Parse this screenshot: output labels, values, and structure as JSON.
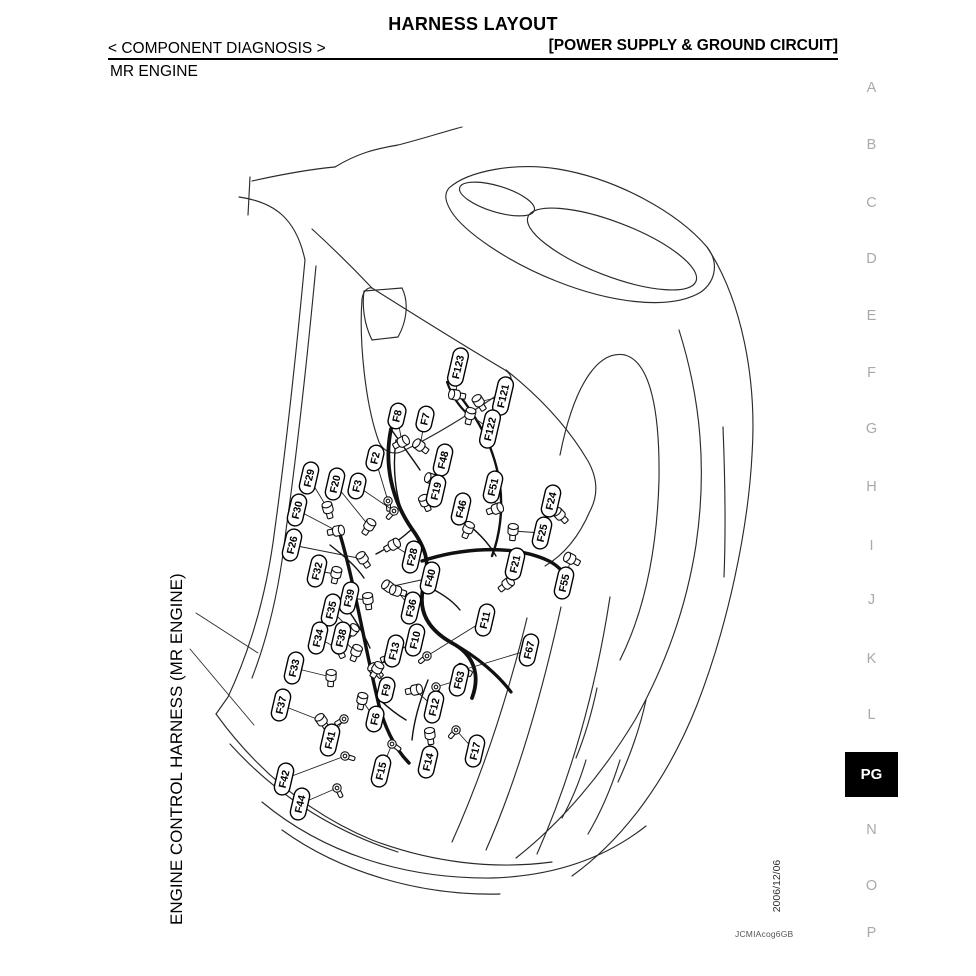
{
  "page": {
    "bg": "#ffffff",
    "ink": "#000000"
  },
  "header": {
    "title": "HARNESS LAYOUT",
    "section": "< COMPONENT DIAGNOSIS >",
    "subsection": "[POWER SUPPLY & GROUND CIRCUIT]",
    "page_heading": "MR ENGINE"
  },
  "diagram": {
    "side_caption": "ENGINE CONTROL HARNESS (MR ENGINE)",
    "connector_label_style": {
      "fill": "#ffffff",
      "stroke": "#000000"
    },
    "connectors": [
      {
        "id": "F123",
        "x": 458,
        "y": 367,
        "dx": -2,
        "dy": 28,
        "t": "bolt"
      },
      {
        "id": "F121",
        "x": 503,
        "y": 396,
        "dx": -24,
        "dy": 6,
        "t": "bolt"
      },
      {
        "id": "F122",
        "x": 490,
        "y": 429,
        "dx": -20,
        "dy": -14,
        "t": "bolt"
      },
      {
        "id": "F8",
        "x": 397,
        "y": 416,
        "dx": 5,
        "dy": 26,
        "t": "bolt"
      },
      {
        "id": "F7",
        "x": 425,
        "y": 419,
        "dx": -5,
        "dy": 27,
        "t": "bolt"
      },
      {
        "id": "F2",
        "x": 375,
        "y": 458,
        "dx": 13,
        "dy": 43,
        "t": "eyelet"
      },
      {
        "id": "F3",
        "x": 357,
        "y": 486,
        "dx": 37,
        "dy": 25,
        "t": "eyelet"
      },
      {
        "id": "F48",
        "x": 443,
        "y": 460,
        "dx": -11,
        "dy": 19,
        "t": "bolt"
      },
      {
        "id": "F19",
        "x": 436,
        "y": 491,
        "dx": -11,
        "dy": 11,
        "t": "bolt"
      },
      {
        "id": "F46",
        "x": 461,
        "y": 509,
        "dx": 7,
        "dy": 20,
        "t": "bolt"
      },
      {
        "id": "F51",
        "x": 493,
        "y": 487,
        "dx": 3,
        "dy": 22,
        "t": "bolt"
      },
      {
        "id": "F24",
        "x": 551,
        "y": 501,
        "dx": 9,
        "dy": 14,
        "t": "bolt"
      },
      {
        "id": "F25",
        "x": 542,
        "y": 533,
        "dx": -29,
        "dy": -2,
        "t": "bolt"
      },
      {
        "id": "F21",
        "x": 515,
        "y": 564,
        "dx": -8,
        "dy": 20,
        "t": "bolt"
      },
      {
        "id": "F55",
        "x": 564,
        "y": 583,
        "dx": 7,
        "dy": -24,
        "t": "bolt"
      },
      {
        "id": "F29",
        "x": 309,
        "y": 478,
        "dx": 19,
        "dy": 31,
        "t": "bolt"
      },
      {
        "id": "F20",
        "x": 335,
        "y": 484,
        "dx": 34,
        "dy": 42,
        "t": "bolt"
      },
      {
        "id": "F30",
        "x": 297,
        "y": 510,
        "dx": 40,
        "dy": 21,
        "t": "bolt"
      },
      {
        "id": "F26",
        "x": 292,
        "y": 545,
        "dx": 71,
        "dy": 14,
        "t": "bolt"
      },
      {
        "id": "F32",
        "x": 317,
        "y": 571,
        "dx": 19,
        "dy": 3,
        "t": "bolt"
      },
      {
        "id": "F28",
        "x": 412,
        "y": 557,
        "dx": -19,
        "dy": -12,
        "t": "bolt"
      },
      {
        "id": "F40",
        "x": 430,
        "y": 578,
        "dx": -41,
        "dy": 9,
        "t": "bolt"
      },
      {
        "id": "F39",
        "x": 349,
        "y": 598,
        "dx": 19,
        "dy": 2,
        "t": "bolt"
      },
      {
        "id": "F35",
        "x": 331,
        "y": 610,
        "dx": 21,
        "dy": 21,
        "t": "bolt"
      },
      {
        "id": "F36",
        "x": 411,
        "y": 608,
        "dx": -14,
        "dy": -17,
        "t": "bolt"
      },
      {
        "id": "F34",
        "x": 318,
        "y": 638,
        "dx": 21,
        "dy": 11,
        "t": "bolt"
      },
      {
        "id": "F38",
        "x": 341,
        "y": 638,
        "dx": 15,
        "dy": 14,
        "t": "bolt"
      },
      {
        "id": "F10",
        "x": 415,
        "y": 640,
        "dx": -25,
        "dy": 17,
        "t": "bolt"
      },
      {
        "id": "F13",
        "x": 394,
        "y": 651,
        "dx": -19,
        "dy": 19,
        "t": "bolt"
      },
      {
        "id": "F33",
        "x": 294,
        "y": 668,
        "dx": 37,
        "dy": 9,
        "t": "bolt"
      },
      {
        "id": "F11",
        "x": 485,
        "y": 620,
        "dx": -58,
        "dy": 36,
        "t": "eyelet"
      },
      {
        "id": "F67",
        "x": 529,
        "y": 650,
        "dx": -66,
        "dy": 20,
        "t": "bolt"
      },
      {
        "id": "F63",
        "x": 459,
        "y": 680,
        "dx": -23,
        "dy": 7,
        "t": "eyelet"
      },
      {
        "id": "F9",
        "x": 386,
        "y": 690,
        "dx": -9,
        "dy": -21,
        "t": "bolt"
      },
      {
        "id": "F12",
        "x": 434,
        "y": 707,
        "dx": -19,
        "dy": -17,
        "t": "bolt"
      },
      {
        "id": "F37",
        "x": 281,
        "y": 705,
        "dx": 41,
        "dy": 16,
        "t": "bolt"
      },
      {
        "id": "F6",
        "x": 375,
        "y": 719,
        "dx": -13,
        "dy": -19,
        "t": "bolt"
      },
      {
        "id": "F41",
        "x": 330,
        "y": 740,
        "dx": 14,
        "dy": -21,
        "t": "eyelet"
      },
      {
        "id": "F15",
        "x": 381,
        "y": 771,
        "dx": 11,
        "dy": -27,
        "t": "eyelet"
      },
      {
        "id": "F14",
        "x": 428,
        "y": 762,
        "dx": 2,
        "dy": -27,
        "t": "bolt"
      },
      {
        "id": "F17",
        "x": 475,
        "y": 751,
        "dx": -19,
        "dy": -21,
        "t": "eyelet"
      },
      {
        "id": "F42",
        "x": 284,
        "y": 779,
        "dx": 61,
        "dy": -23,
        "t": "eyelet"
      },
      {
        "id": "F44",
        "x": 300,
        "y": 804,
        "dx": 37,
        "dy": -16,
        "t": "eyelet"
      }
    ]
  },
  "sidebar": {
    "inactive_color": "#a9a9a9",
    "items": [
      {
        "label": "A",
        "y": 90
      },
      {
        "label": "B",
        "y": 147
      },
      {
        "label": "C",
        "y": 205
      },
      {
        "label": "D",
        "y": 261
      },
      {
        "label": "E",
        "y": 318
      },
      {
        "label": "F",
        "y": 375
      },
      {
        "label": "G",
        "y": 431
      },
      {
        "label": "H",
        "y": 489
      },
      {
        "label": "I",
        "y": 548
      },
      {
        "label": "J",
        "y": 602
      },
      {
        "label": "K",
        "y": 661
      },
      {
        "label": "L",
        "y": 717
      },
      {
        "label": "N",
        "y": 832
      },
      {
        "label": "O",
        "y": 888
      },
      {
        "label": "P",
        "y": 935
      }
    ],
    "active": {
      "label": "PG",
      "x": 845,
      "y": 752,
      "w": 53,
      "h": 45
    }
  },
  "footer": {
    "date": "2006/12/06",
    "figure_code": "JCMIAcog6GB"
  }
}
